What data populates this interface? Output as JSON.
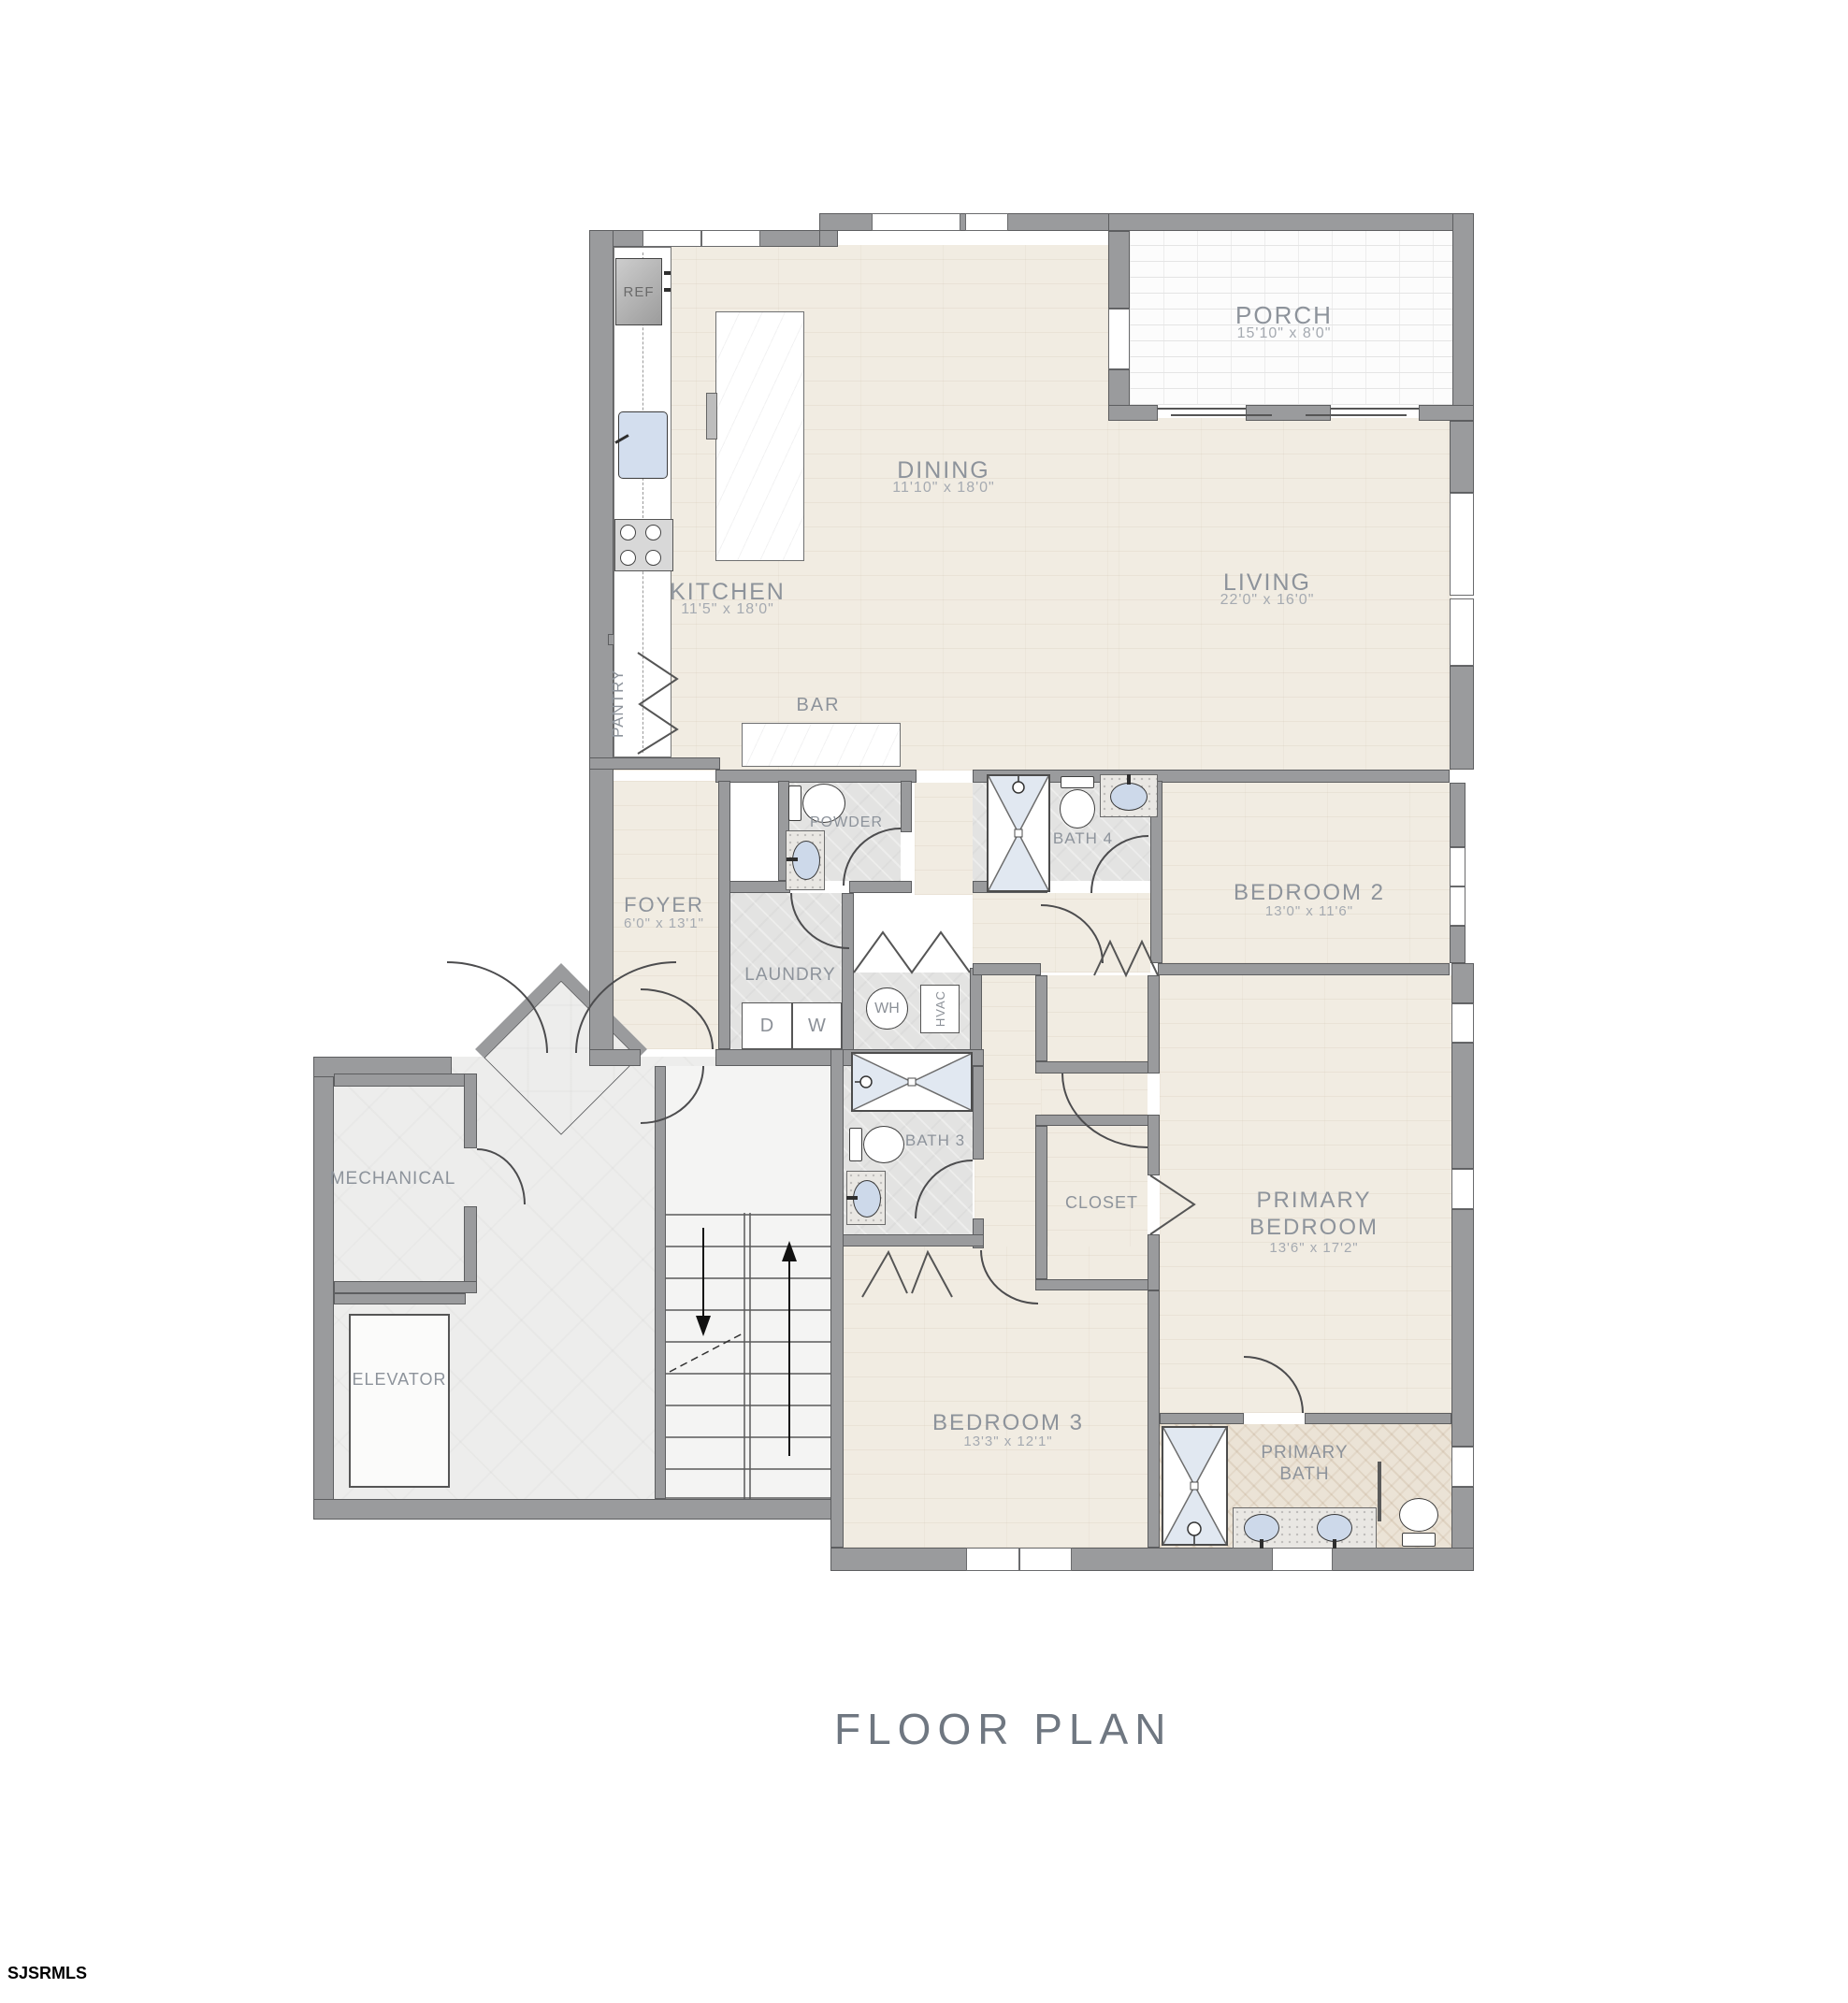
{
  "title": "FLOOR PLAN",
  "watermark": "SJSRMLS",
  "rooms": {
    "porch": {
      "name": "PORCH",
      "dims": "15'10\" x 8'0\""
    },
    "dining": {
      "name": "DINING",
      "dims": "11'10\" x 18'0\""
    },
    "living": {
      "name": "LIVING",
      "dims": "22'0\" x 16'0\""
    },
    "kitchen": {
      "name": "KITCHEN",
      "dims": "11'5\" x 18'0\""
    },
    "pantry": {
      "name": "PANTRY"
    },
    "bar": {
      "name": "BAR"
    },
    "powder": {
      "name": "POWDER"
    },
    "foyer": {
      "name": "FOYER",
      "dims": "6'0\" x 13'1\""
    },
    "laundry": {
      "name": "LAUNDRY"
    },
    "bath4": {
      "name": "BATH 4"
    },
    "bedroom2": {
      "name": "BEDROOM 2",
      "dims": "13'0\" x 11'6\""
    },
    "bath3": {
      "name": "BATH 3"
    },
    "closet": {
      "name": "CLOSET"
    },
    "primary_bedroom": {
      "name": "PRIMARY BEDROOM",
      "dims": "13'6\" x 17'2\""
    },
    "mechanical": {
      "name": "MECHANICAL"
    },
    "elevator": {
      "name": "ELEVATOR"
    },
    "bedroom3": {
      "name": "BEDROOM 3",
      "dims": "13'3\" x 12'1\""
    },
    "primary_bath": {
      "name": "PRIMARY BATH"
    }
  },
  "fixtures": {
    "refrigerator": "REF",
    "dryer": "D",
    "washer": "W",
    "water_heater": "WH",
    "hvac": "HVAC"
  }
}
